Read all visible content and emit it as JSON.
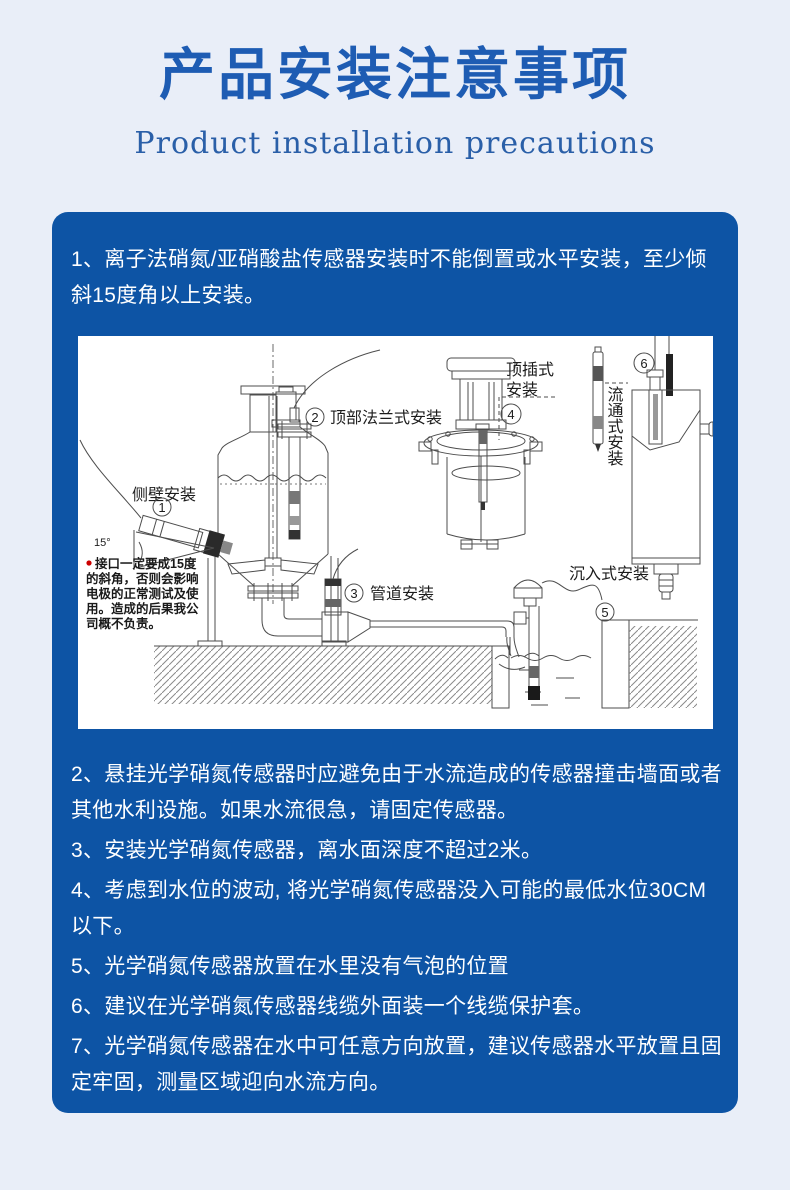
{
  "page": {
    "title": "产品安装注意事项",
    "subtitle": "Product installation precautions"
  },
  "colors": {
    "page_bg": "#e9eef8",
    "card_bg": "#0d54a5",
    "title_blue": "#1e5cb3",
    "text_white": "#ffffff",
    "warning_red": "#cc0000"
  },
  "card": {
    "items": [
      "1、离子法硝氮/亚硝酸盐传感器安装时不能倒置或水平安装，至少倾斜15度角以上安装。",
      "2、悬挂光学硝氮传感器时应避免由于水流造成的传感器撞击墙面或者其他水利设施。如果水流很急，请固定传感器。",
      "3、安装光学硝氮传感器，离水面深度不超过2米。",
      "4、考虑到水位的波动, 将光学硝氮传感器没入可能的最低水位30CM以下。",
      "5、光学硝氮传感器放置在水里没有气泡的位置",
      "6、建议在光学硝氮传感器线缆外面装一个线缆保护套。",
      "7、光学硝氮传感器在水中可任意方向放置，建议传感器水平放置且固定牢固，测量区域迎向水流方向。"
    ]
  },
  "diagram": {
    "labels": {
      "side_wall": "侧壁安装",
      "top_flange": "顶部法兰式安装",
      "pipeline": "管道安装",
      "top_insert_1": "顶插式",
      "top_insert_2": "安装",
      "immersion": "沉入式安装",
      "flow_through": "流通式安装",
      "angle": "15°"
    },
    "nums": {
      "n1": "1",
      "n2": "2",
      "n3": "3",
      "n4": "4",
      "n5": "5",
      "n6": "6"
    },
    "note": [
      "接口一定要成15度",
      "的斜角，否则会影响",
      "电极的正常测试及使",
      "用。造成的后果我公",
      "司概不负责。"
    ]
  }
}
